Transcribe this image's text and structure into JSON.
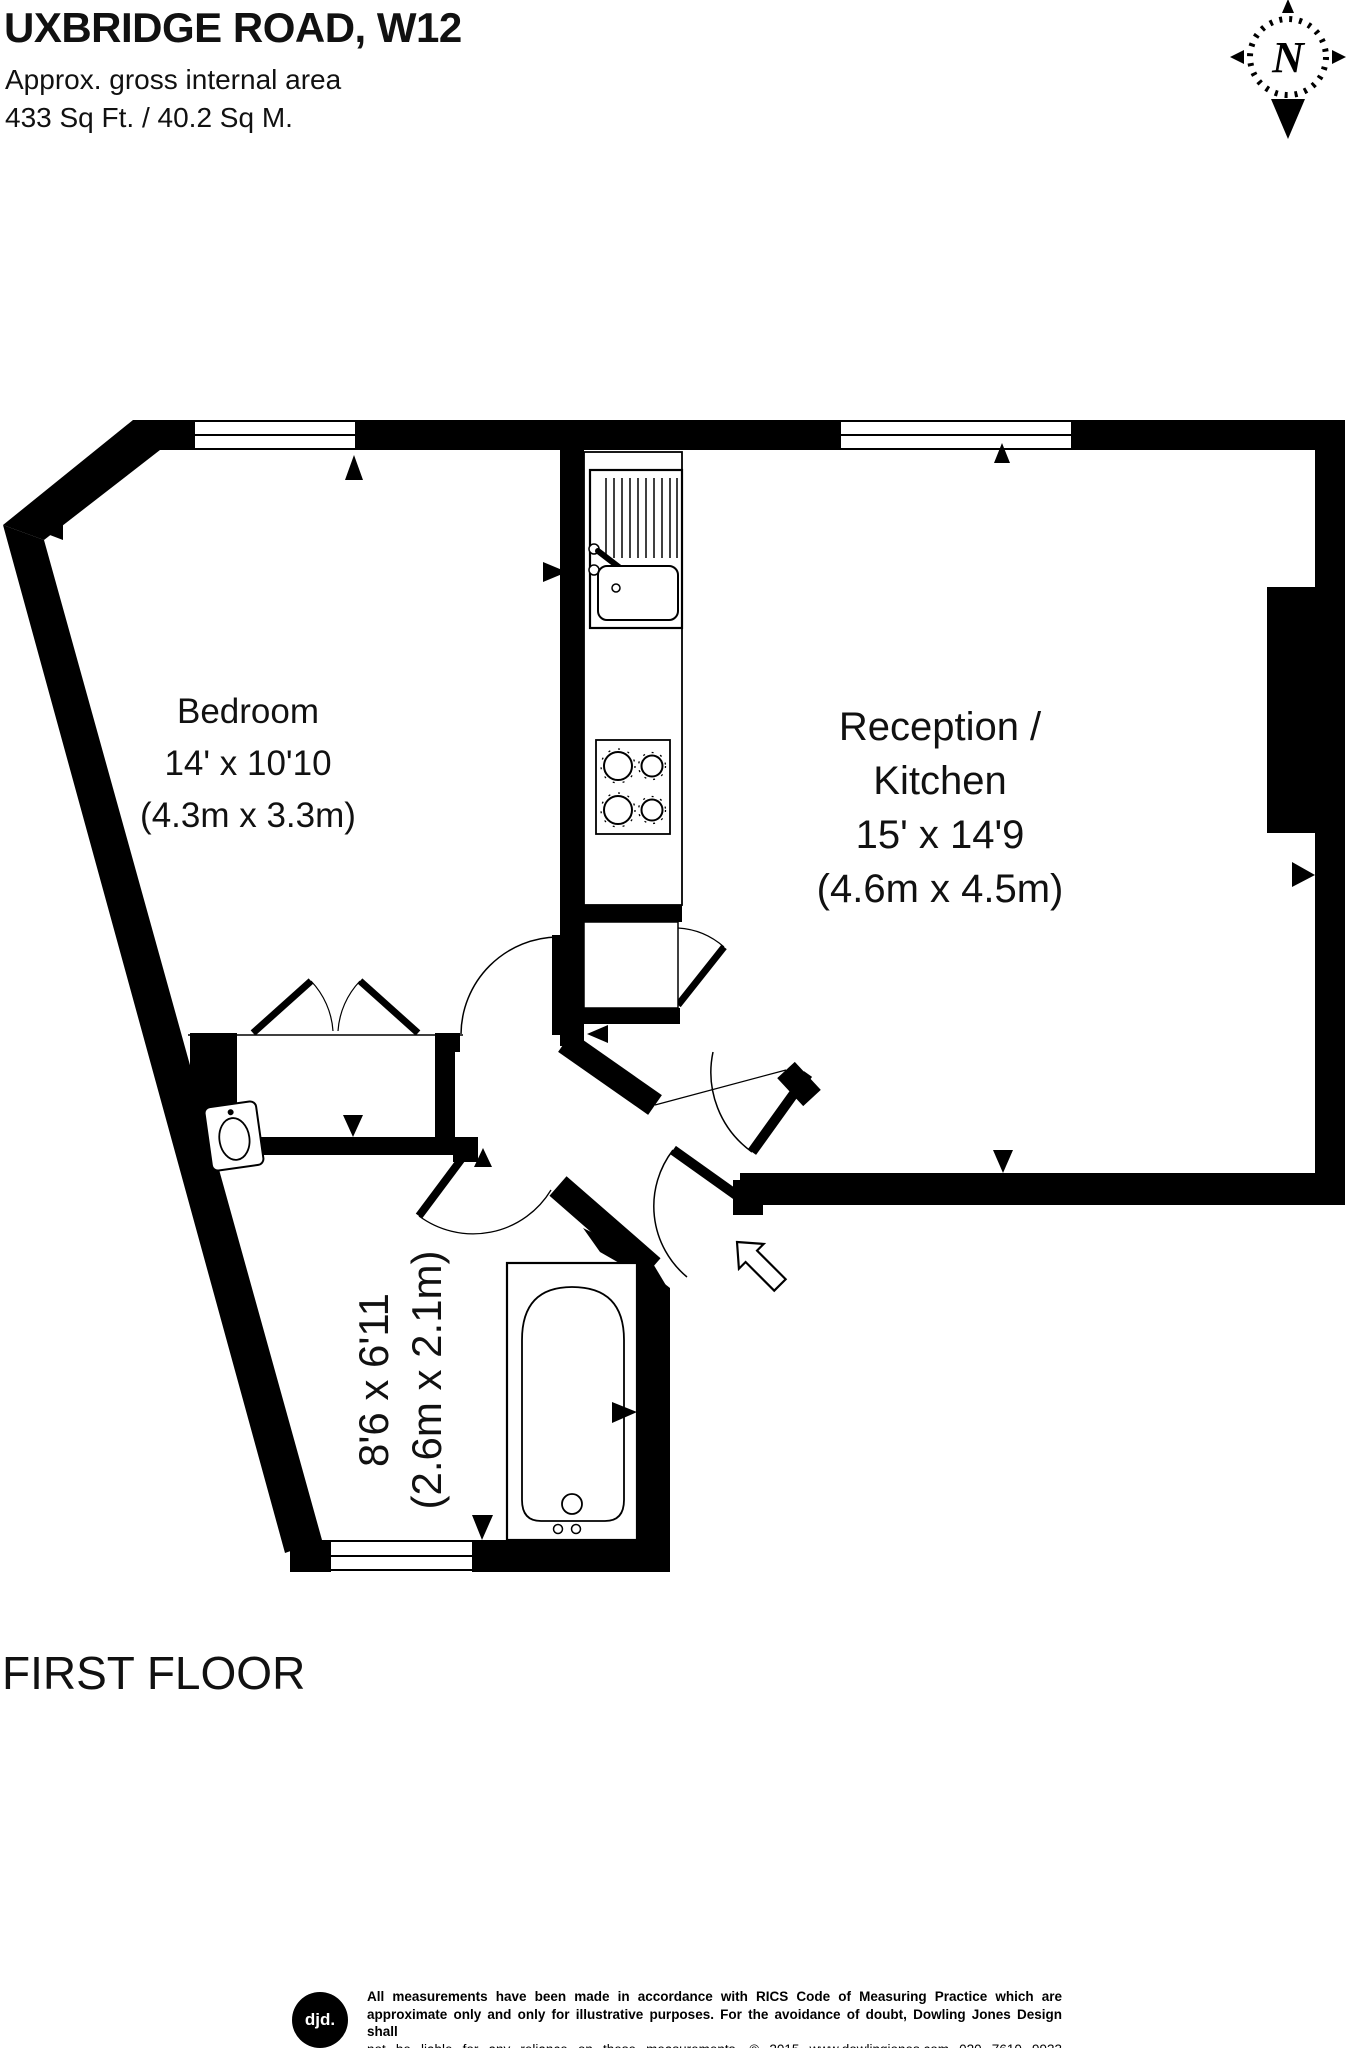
{
  "header": {
    "title": "UXBRIDGE ROAD, W12",
    "subtitle": "Approx. gross internal area",
    "area": "433 Sq Ft. / 40.2 Sq M."
  },
  "compass": {
    "label": "N"
  },
  "rooms": {
    "bedroom": {
      "name": "Bedroom",
      "imperial": "14' x 10'10",
      "metric": "(4.3m x 3.3m)"
    },
    "reception": {
      "name_line1": "Reception /",
      "name_line2": "Kitchen",
      "imperial": "15' x 14'9",
      "metric": "(4.6m x 4.5m)"
    },
    "bathroom": {
      "imperial": "8'6 x 6'11",
      "metric": "(2.6m x 2.1m)"
    }
  },
  "floor_label": "FIRST FLOOR",
  "footer": {
    "logo_text": "djd.",
    "line1": "All measurements have been made in accordance with RICS Code of Measuring Practice which are",
    "line2": "approximate only and only for illustrative purposes. For the avoidance of doubt, Dowling Jones Design shall",
    "line3": "not be liable for any reliance on these measurements. © 2015 www.dowlingjones.com 020 7610 9933"
  },
  "colors": {
    "wall": "#000000",
    "background": "#ffffff",
    "text": "#111111"
  }
}
